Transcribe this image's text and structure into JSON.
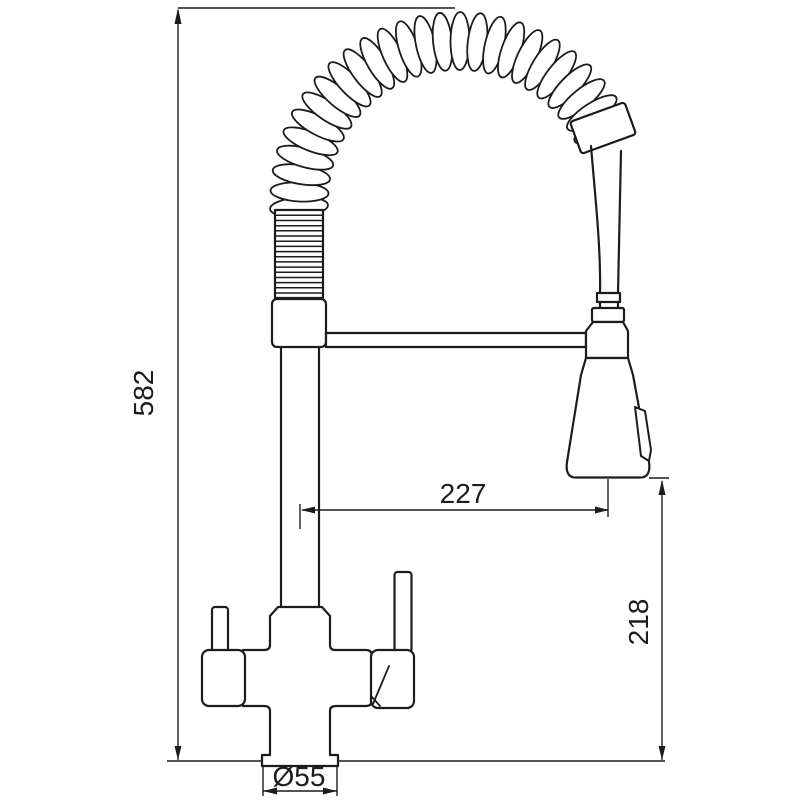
{
  "page": {
    "background": "#ffffff"
  },
  "drawing": {
    "line_color": "#1c1c1c",
    "dimensions": {
      "overall_height": "582",
      "spout_reach": "227",
      "outlet_height": "218",
      "base_diameter": "Ø55"
    }
  }
}
